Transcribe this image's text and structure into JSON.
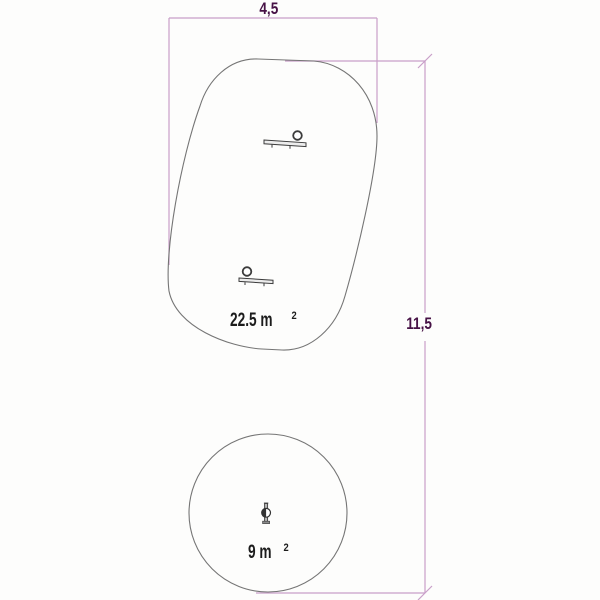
{
  "drawing": {
    "type": "playground-safety-zone-plan",
    "colors": {
      "dimension_line": "#c99fc9",
      "dimension_text": "#471246",
      "outline": "#757575",
      "icon": "#3c3c3c",
      "area_text": "#1c1c1c"
    },
    "dimensions": {
      "width": {
        "label": "4,5"
      },
      "height": {
        "label": "11,5"
      }
    },
    "zones": [
      {
        "id": "rounded-safety-zone",
        "shape": "rounded-rectangle",
        "area_value": "22.5 m",
        "area_sup": "2"
      },
      {
        "id": "circular-safety-zone",
        "shape": "circle",
        "area_value": "9 m",
        "area_sup": "2"
      }
    ],
    "icons": [
      {
        "name": "spring-rider-side-top"
      },
      {
        "name": "spring-rider-side-bottom"
      },
      {
        "name": "spring-rider-front"
      }
    ]
  }
}
